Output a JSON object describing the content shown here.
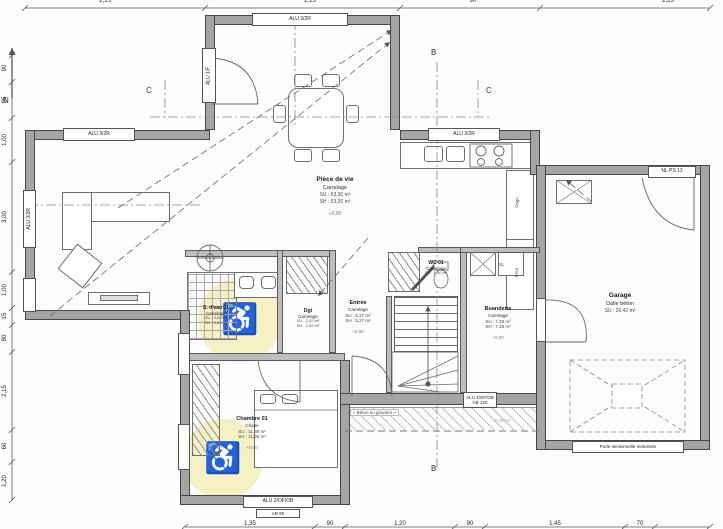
{
  "compass": {
    "label": "N"
  },
  "dims": {
    "top": [
      "2,13",
      "2,13",
      "90",
      "2,13"
    ],
    "left": [
      "90",
      "95",
      "1,00",
      "3,00",
      "1,00",
      "15",
      "80",
      "2,15",
      "60",
      "1,20"
    ],
    "bottom": [
      "1,35",
      "90",
      "1,20",
      "90",
      "1,45",
      "70"
    ]
  },
  "sections": {
    "c": "C",
    "b": "B"
  },
  "rooms": {
    "living": {
      "name": "Pièce de vie",
      "floor": "Carrelage",
      "su": "SU : 53,30 m²",
      "sh": "SH : 53,20 m²",
      "level": "+0,00"
    },
    "bathroom": {
      "name": "S. d'eau 01",
      "floor": "Carrelage",
      "su": "SU : 4,60 m²",
      "sh": "SH : 4,60 m²"
    },
    "dressing": {
      "name": "Dgt",
      "floor": "Carrelage",
      "su": "SU : 2,02 m²",
      "sh": "SH : 2,02 m²"
    },
    "entry": {
      "name": "Entrée",
      "floor": "Carrelage",
      "su": "SU : 5,27 m²",
      "sh": "SH : 5,27 m²",
      "level": "+0,00"
    },
    "wc": {
      "name": "WC 01",
      "floor": "Carrelage",
      "su": "SU : 1,50 m²"
    },
    "laundry": {
      "name": "Buanderie",
      "floor": "Carrelage",
      "su": "SU : 7,28 m²",
      "sh": "SH : 7,28 m²",
      "level": "+0,00"
    },
    "garage": {
      "name": "Garage",
      "floor": "Dalle béton",
      "su": "SU : 26,42 m²"
    },
    "bedroom": {
      "name": "Chambre 01",
      "floor": "Chape",
      "su": "SU : 11,38 m²",
      "sh": "SH : 11,38 m²",
      "level": "+0,00"
    }
  },
  "openings": {
    "bay_top": "ALU 3/2R",
    "bay_side_door": "ALU 1/F",
    "living_top": "ALU 3/2R",
    "living_side": "ALU 3/2R",
    "kitchen": "ALU 3/2R",
    "garage_service_door": "NL PS 13",
    "entry_window_l1": "ALU 2/OF/OB",
    "entry_window_l2": "AB 120",
    "bedroom_window": "ALU 2/OF/OB",
    "bedroom_window_sub": "AB 90",
    "garage_door": "Porte sectionnelle motorisée"
  },
  "labels": {
    "terrace_note": "« Béton ou graviers »",
    "terrace_note2": "À définir",
    "fridge": "Frigo",
    "oven": "Four",
    "sl": "SL",
    "accessibility": "♿"
  }
}
